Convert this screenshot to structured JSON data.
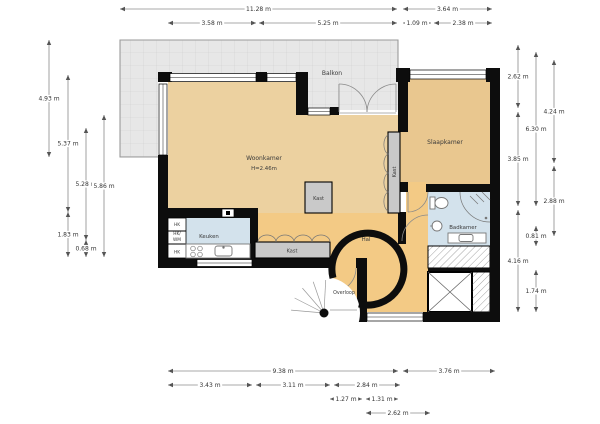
{
  "rooms": {
    "balkon": "Balkon",
    "woonkamer": "Woonkamer",
    "woonkamer_height": "H=2.46m",
    "slaapkamer": "Slaapkamer",
    "keuken": "Keuken",
    "hal": "Hal",
    "badkamer": "Badkamer",
    "overloop": "Overloop",
    "kast_center": "Kast",
    "kast_wardrobe": "Kast",
    "kast_bedroom": "Kast",
    "hk_top": "HK",
    "hk_mid_line1": "HK/",
    "hk_mid_line2": "WM",
    "hk_bottom": "HK"
  },
  "colors": {
    "floor_living": "#ecd1a0",
    "floor_bedroom": "#e9c78f",
    "floor_hall": "#f3ca85",
    "wet_room": "#d3e2ec",
    "balcony": "#e7e7e7",
    "closet": "#c9c9c9",
    "wall": "#0d0d0d"
  },
  "dimensions": {
    "top": [
      {
        "label": "11.28 m",
        "x1": 120,
        "x2": 397,
        "y": 9
      },
      {
        "label": "3.64 m",
        "x1": 403,
        "x2": 492,
        "y": 9
      },
      {
        "label": "3.58 m",
        "x1": 168,
        "x2": 256,
        "y": 23
      },
      {
        "label": "5.25 m",
        "x1": 259,
        "x2": 397,
        "y": 23
      },
      {
        "label": "1.09 m",
        "x1": 403,
        "x2": 431,
        "y": 23
      },
      {
        "label": "2.38 m",
        "x1": 434,
        "x2": 492,
        "y": 23
      }
    ],
    "bottom": [
      {
        "label": "9.38 m",
        "x1": 168,
        "x2": 398,
        "y": 371
      },
      {
        "label": "3.76 m",
        "x1": 403,
        "x2": 495,
        "y": 371
      },
      {
        "label": "3.43 m",
        "x1": 168,
        "x2": 252,
        "y": 385
      },
      {
        "label": "3.11 m",
        "x1": 256,
        "x2": 330,
        "y": 385
      },
      {
        "label": "2.84 m",
        "x1": 334,
        "x2": 400,
        "y": 385
      },
      {
        "label": "1.27 m",
        "x1": 330,
        "x2": 362,
        "y": 399
      },
      {
        "label": "1.31 m",
        "x1": 366,
        "x2": 398,
        "y": 399
      },
      {
        "label": "2.62 m",
        "x1": 366,
        "x2": 430,
        "y": 413
      }
    ],
    "left": [
      {
        "label": "4.93 m",
        "y1": 40,
        "y2": 157,
        "x": 49
      },
      {
        "label": "5.37 m",
        "y1": 75,
        "y2": 212,
        "x": 68
      },
      {
        "label": "5.28 m",
        "y1": 128,
        "y2": 240,
        "x": 86
      },
      {
        "label": "5.86 m",
        "y1": 115,
        "y2": 257,
        "x": 104
      },
      {
        "label": "1.83 m",
        "y1": 212,
        "y2": 257,
        "x": 68
      },
      {
        "label": "0.68 m",
        "y1": 240,
        "y2": 257,
        "x": 86
      }
    ],
    "right": [
      {
        "label": "2.62 m",
        "y1": 45,
        "y2": 108,
        "x": 518
      },
      {
        "label": "3.85 m",
        "y1": 112,
        "y2": 206,
        "x": 518
      },
      {
        "label": "4.16 m",
        "y1": 210,
        "y2": 312,
        "x": 518
      },
      {
        "label": "6.30 m",
        "y1": 52,
        "y2": 206,
        "x": 536
      },
      {
        "label": "0.81 m",
        "y1": 226,
        "y2": 246,
        "x": 536
      },
      {
        "label": "1.74 m",
        "y1": 270,
        "y2": 312,
        "x": 536
      },
      {
        "label": "4.24 m",
        "y1": 60,
        "y2": 163,
        "x": 554
      },
      {
        "label": "2.88 m",
        "y1": 166,
        "y2": 236,
        "x": 554
      }
    ]
  }
}
